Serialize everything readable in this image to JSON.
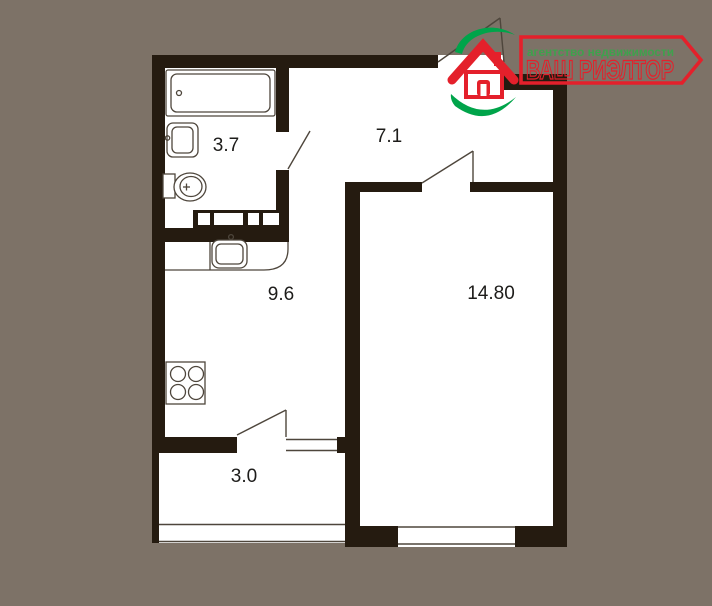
{
  "logo": {
    "agency_line": "агентство недвижимости",
    "brand": "ВАШ РИЭЛТОР",
    "red": "#e4202b",
    "green": "#00a44a",
    "agency_text_green": "#3fa14d"
  },
  "plan": {
    "background_color": "#7d7267",
    "wall_color": "#251b10",
    "floor_color": "#ffffff",
    "thin_line_color": "#4e463c",
    "rooms": [
      {
        "name": "bathroom",
        "area": "3.7"
      },
      {
        "name": "hallway",
        "area": "7.1"
      },
      {
        "name": "kitchen",
        "area": "9.6"
      },
      {
        "name": "living-room",
        "area": "14.80"
      },
      {
        "name": "balcony",
        "area": "3.0"
      }
    ]
  }
}
